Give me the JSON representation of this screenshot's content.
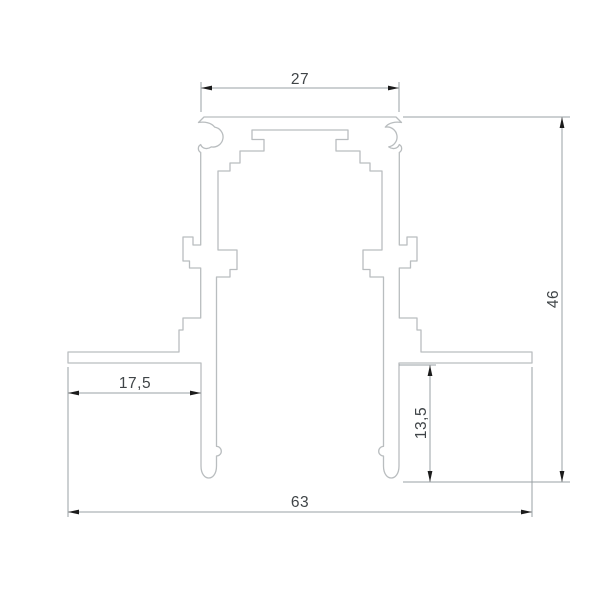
{
  "window": {
    "width": 600,
    "height": 600
  },
  "drawing": {
    "type": "cad-cross-section-technical-drawing",
    "subject": "recessed-track-profile",
    "dimension_labels": {
      "top_width": "27",
      "overall_height": "46",
      "left_flange_width": "17,5",
      "recess_depth": "13,5",
      "overall_width": "63"
    },
    "colors": {
      "background": "#ffffff",
      "profile_line": "#b9bdbf",
      "dimension_line": "#9aa0a4",
      "arrow": "#1c1c1c",
      "text": "#3f4447"
    }
  }
}
